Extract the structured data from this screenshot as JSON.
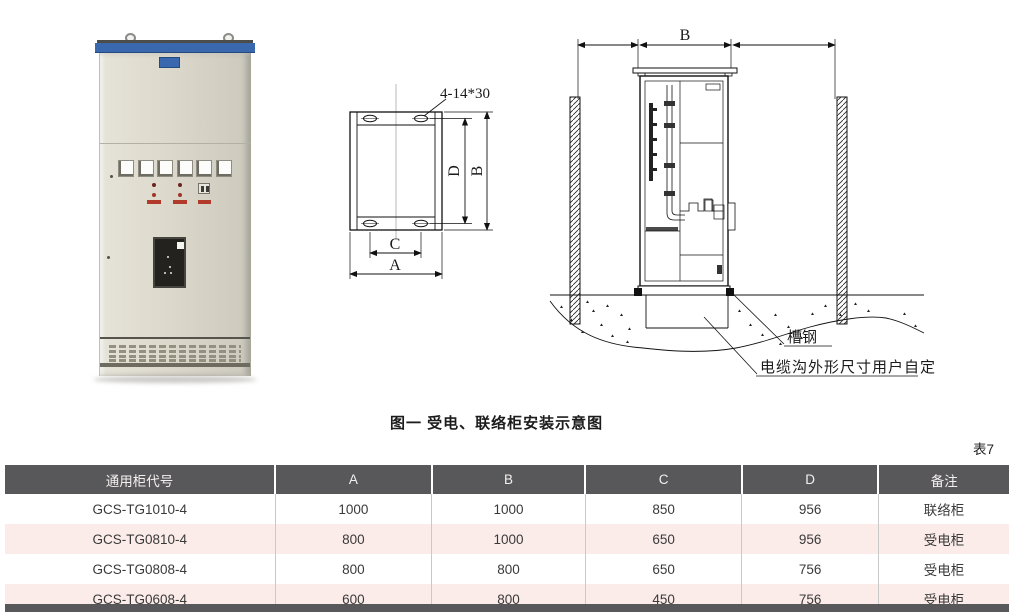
{
  "page": {
    "figure_caption": "图一 受电、联络柜安装示意图",
    "table_tag": "表7",
    "background": "#ffffff"
  },
  "photo": {
    "accent_blue": "#3a68ae",
    "body_color": "#dcd9cc"
  },
  "mounting_plan": {
    "hole_label": "4-14*30",
    "dim_labels": {
      "a": "A",
      "b": "B",
      "c": "C",
      "d": "D"
    }
  },
  "installation_view": {
    "dim_label_b": "B",
    "channel_steel_label": "槽钢",
    "cable_trench_label": "电缆沟外形尺寸用户自定"
  },
  "table": {
    "header_bg": "#58585a",
    "row_alt_bg": "#fbece9",
    "headers": [
      "通用柜代号",
      "A",
      "B",
      "C",
      "D",
      "备注"
    ],
    "rows": [
      [
        "GCS-TG1010-4",
        "1000",
        "1000",
        "850",
        "956",
        "联络柜"
      ],
      [
        "GCS-TG0810-4",
        "800",
        "1000",
        "650",
        "956",
        "受电柜"
      ],
      [
        "GCS-TG0808-4",
        "800",
        "800",
        "650",
        "756",
        "受电柜"
      ],
      [
        "GCS-TG0608-4",
        "600",
        "800",
        "450",
        "756",
        "受电柜"
      ]
    ]
  }
}
